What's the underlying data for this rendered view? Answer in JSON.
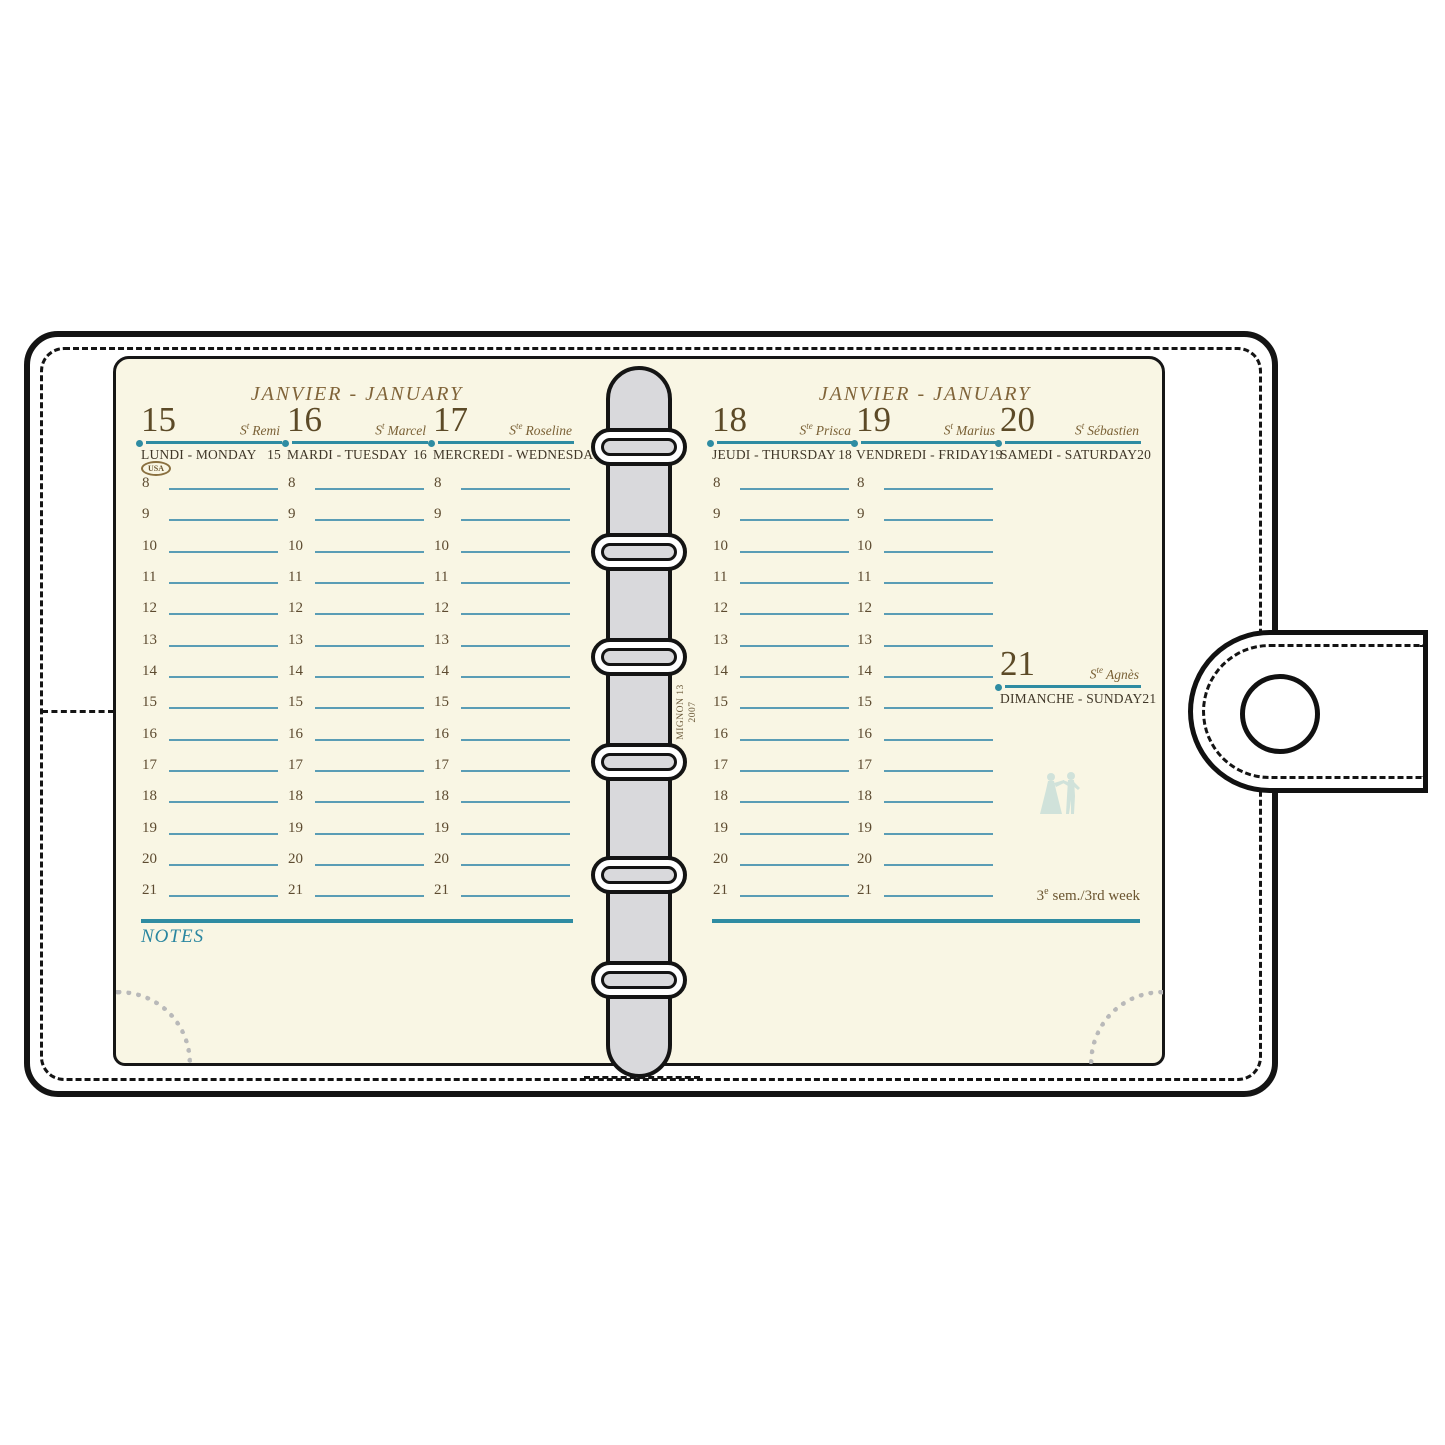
{
  "titles": {
    "left": "JANVIER - JANUARY",
    "right": "JANVIER - JANUARY"
  },
  "days": [
    {
      "num": "15",
      "saint_prefix": "S",
      "saint_sup": "t",
      "saint_name": "Remi",
      "label": "LUNDI - MONDAY",
      "label_num": "15",
      "badge": "USA"
    },
    {
      "num": "16",
      "saint_prefix": "S",
      "saint_sup": "t",
      "saint_name": "Marcel",
      "label": "MARDI - TUESDAY",
      "label_num": "16"
    },
    {
      "num": "17",
      "saint_prefix": "S",
      "saint_sup": "te",
      "saint_name": "Roseline",
      "label": "MERCREDI - WEDNESDAY",
      "label_num": "17"
    },
    {
      "num": "18",
      "saint_prefix": "S",
      "saint_sup": "te",
      "saint_name": "Prisca",
      "label": "JEUDI - THURSDAY",
      "label_num": "18"
    },
    {
      "num": "19",
      "saint_prefix": "S",
      "saint_sup": "t",
      "saint_name": "Marius",
      "label": "VENDREDI - FRIDAY",
      "label_num": "19"
    },
    {
      "num": "20",
      "saint_prefix": "S",
      "saint_sup": "t",
      "saint_name": "Sébastien",
      "label": "SAMEDI - SATURDAY",
      "label_num": "20"
    },
    {
      "num": "21",
      "saint_prefix": "S",
      "saint_sup": "te",
      "saint_name": "Agnès",
      "label": "DIMANCHE - SUNDAY",
      "label_num": "21"
    }
  ],
  "hours": [
    "8",
    "9",
    "10",
    "11",
    "12",
    "13",
    "14",
    "15",
    "16",
    "17",
    "18",
    "19",
    "20",
    "21"
  ],
  "notes_label": "NOTES",
  "week_label": {
    "num": "3",
    "sup": "e",
    "rest": "sem./3rd week"
  },
  "spine_text": {
    "line1": "MIGNON 13",
    "line2": "2007"
  },
  "colors": {
    "page_cream": "#f9f6e4",
    "rule_teal": "#2f8ca2",
    "hour_line_teal": "#5a9db5",
    "notes_teal": "#2a86a0",
    "title_brown": "#806439",
    "number_brown": "#5c4a27",
    "label_dark": "#3f3627",
    "spine_gray": "#d9d9dc",
    "outline_black": "#141414",
    "corner_dot_gray": "#b9b9b9",
    "watermark_blue": "#c3dcd7"
  }
}
